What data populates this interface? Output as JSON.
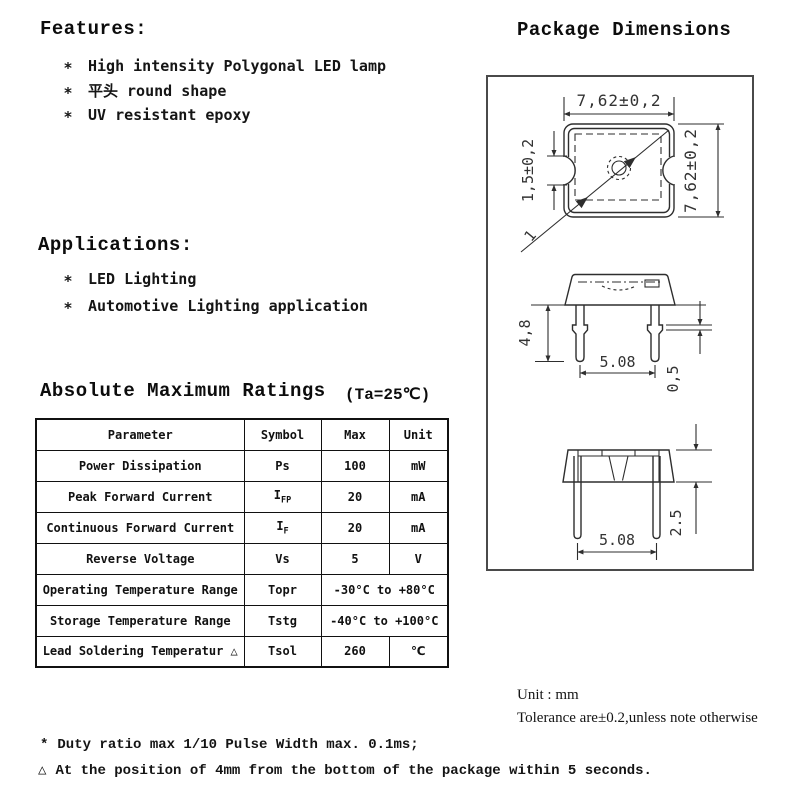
{
  "features": {
    "title": "Features:",
    "bullet": "*",
    "items": [
      "High intensity Polygonal LED lamp",
      "平头 round shape",
      "UV resistant epoxy"
    ]
  },
  "applications": {
    "title": "Applications:",
    "bullet": "*",
    "items": [
      "LED Lighting",
      "Automotive Lighting application"
    ]
  },
  "ratings": {
    "title": "Absolute Maximum Ratings",
    "condition": "(Ta=25℃)",
    "columns": [
      "Parameter",
      "Symbol",
      "Max",
      "Unit"
    ],
    "rows": [
      {
        "parameter": "Power Dissipation",
        "symbol": "Ps",
        "symbol_sub": "",
        "max": "100",
        "unit": "mW"
      },
      {
        "parameter": "Peak Forward Current",
        "symbol": "I",
        "symbol_sub": "FP",
        "max": "20",
        "unit": "mA"
      },
      {
        "parameter": "Continuous Forward Current",
        "symbol": "I",
        "symbol_sub": "F",
        "max": "20",
        "unit": "mA"
      },
      {
        "parameter": "Reverse Voltage",
        "symbol": "Vs",
        "symbol_sub": "",
        "max": "5",
        "unit": "V"
      },
      {
        "parameter": "Operating Temperature Range",
        "symbol": "Topr",
        "symbol_sub": "",
        "range": "-30°C to +80°C"
      },
      {
        "parameter": "Storage Temperature Range",
        "symbol": "Tstg",
        "symbol_sub": "",
        "range": "-40°C to +100°C"
      },
      {
        "parameter": "Lead Soldering Temperatur △",
        "symbol": "Tsol",
        "symbol_sub": "",
        "max": "260",
        "unit": "℃"
      }
    ]
  },
  "package": {
    "title": "Package Dimensions",
    "dims": {
      "top_width": "7,62±0,2",
      "side_height": "7,62±0,2",
      "notch": "1,5±0,2",
      "diag_mark": "1",
      "lead_length": "4,8",
      "lead_pitch": "5.08",
      "standoff": "0,5",
      "lead_pitch2": "5.08",
      "flange": "2.5"
    }
  },
  "notes": {
    "unit": "Unit :  mm",
    "tolerance": "Tolerance are±0.2,unless note otherwise"
  },
  "footnotes": [
    {
      "bullet": "*",
      "text": "Duty ratio max 1/10 Pulse Width max. 0.1ms;"
    },
    {
      "bullet": "△",
      "text": "At the position of 4mm from the bottom of the package within 5 seconds."
    }
  ]
}
